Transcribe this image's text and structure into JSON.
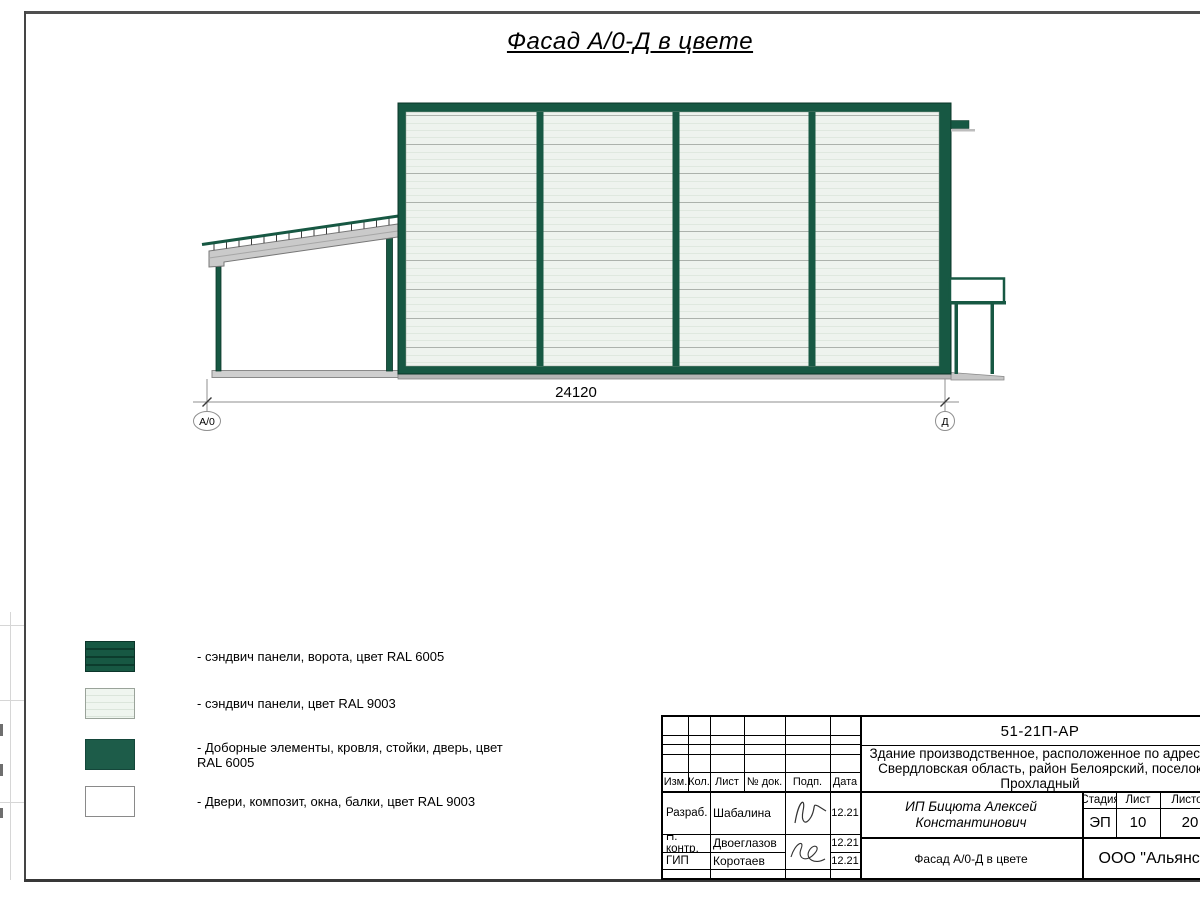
{
  "page": {
    "title": "Фасад А/0-Д в цвете"
  },
  "drawing": {
    "dimension_label": "24120",
    "axis_left_label": "А/0",
    "axis_right_label": "Д",
    "colors": {
      "frame_green": "#175843",
      "frame_green_dark": "#0a3527",
      "panel_light": "#eef3ee",
      "beam_gray": "#cacaca",
      "ground_gray": "#c9c9c9"
    }
  },
  "legend": {
    "items": [
      {
        "label": "- сэндвич панели, ворота, цвет RAL 6005"
      },
      {
        "label": "- сэндвич панели, цвет RAL 9003"
      },
      {
        "label": "- Доборные элементы, кровля, стойки, дверь, цвет RAL 6005"
      },
      {
        "label": "- Двери, композит, окна, балки, цвет RAL 9003"
      }
    ]
  },
  "titleblock": {
    "doc_code": "51-21П-АР",
    "address": "Здание производственное, расположенное по адресу: Свердловская область, район Белоярский, поселок Прохладный",
    "cols": {
      "izm": "Изм.",
      "kol": "Кол.",
      "list": "Лист",
      "doc": "№ док.",
      "podp": "Подп.",
      "data": "Дата"
    },
    "rows": [
      {
        "role": "Разраб.",
        "name": "Шабалина",
        "date": "12.21"
      },
      {
        "role": "Н. контр.",
        "name": "Двоеглазов",
        "date": "12.21"
      },
      {
        "role": "ГИП",
        "name": "Коротаев",
        "date": "12.21"
      }
    ],
    "customer": "ИП Бицюта Алексей Константинович",
    "stage_label": "Стадия",
    "sheet_label": "Лист",
    "sheets_label": "Листов",
    "stage": "ЭП",
    "sheet": "10",
    "sheets": "20",
    "sheet_title": "Фасад А/0-Д в цвете",
    "org": "ООО \"Альянс\""
  }
}
